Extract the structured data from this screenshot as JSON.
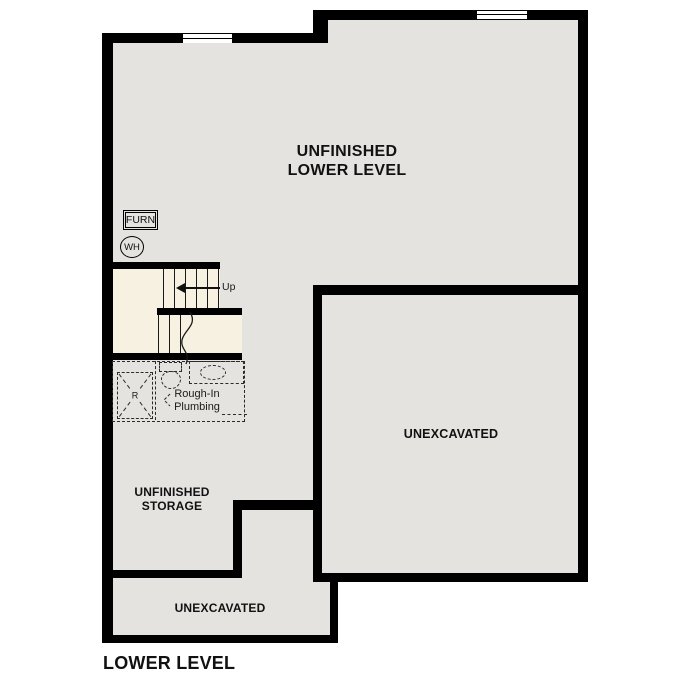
{
  "colors": {
    "wall": "#000000",
    "floor": "#e5e3e0",
    "stair_floor": "#f7f1e2",
    "background": "#ffffff",
    "text": "#111111"
  },
  "plan": {
    "title": "LOWER LEVEL",
    "rooms": {
      "main": {
        "line1": "UNFINISHED",
        "line2": "LOWER LEVEL"
      },
      "unexcavated_right": {
        "label": "UNEXCAVATED"
      },
      "storage": {
        "line1": "UNFINISHED",
        "line2": "STORAGE"
      },
      "unexcavated_bottom": {
        "label": "UNEXCAVATED"
      }
    },
    "annotations": {
      "furnace": "FURN",
      "water_heater": "WH",
      "stairs_up": "Up",
      "rough_in_line1": "Rough-In",
      "rough_in_line2": "Plumbing",
      "tub_mark": "R"
    }
  }
}
